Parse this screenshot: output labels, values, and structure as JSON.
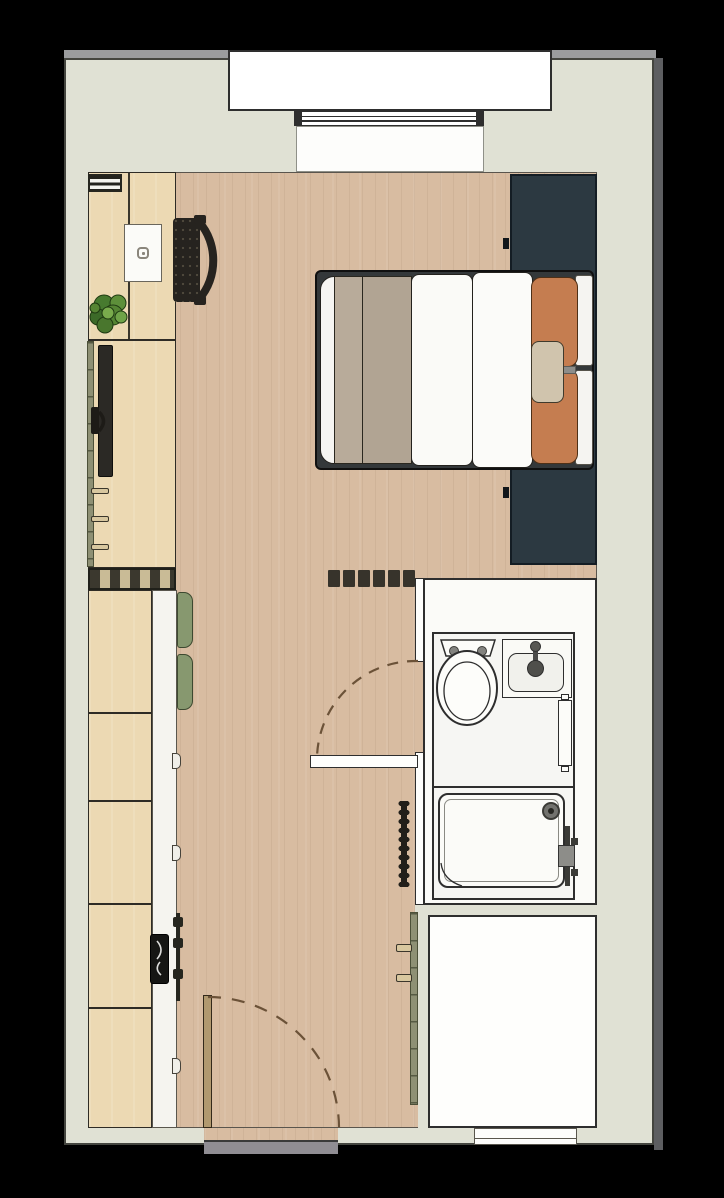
{
  "title": "Studio apartment floor plan",
  "colors": {
    "background": "#000000",
    "wall": "#e0e1d4",
    "wall_edge": "#9b9c9e",
    "outer_edge": "#5d5e61",
    "outline": "#2e2e2e",
    "floor": "#d8bca1",
    "furniture": "#ecd9b3",
    "furniture_line": "#2e2b25",
    "counter": "#f5f4ef",
    "white": "#fdfdfb",
    "tv": "#2b2925",
    "chair_dark": "#26231f",
    "navy": "#2c3941",
    "bed_frame": "#34383a",
    "taupe_a": "#b8ab9a",
    "taupe_b": "#b1a493",
    "duvet": "#fafaf7",
    "orange": "#c57d50",
    "cushion": "#d0c4ad",
    "green": "#87986f",
    "olive": "#8e9074",
    "plant_dark": "#3c6a28",
    "plant_mid": "#4f7f30",
    "plant_light": "#6fa348",
    "door_arc": "#6b5238",
    "door_leaf": "#b1996f",
    "threshold": "#908d93",
    "stripe_dark": "#3b382e",
    "stripe_light": "#c9bb96",
    "handle": "#d8c79f",
    "fixture": "#3b3b37",
    "sink_black": "#161614"
  },
  "items": [
    {
      "name": "balcony-window-bay"
    },
    {
      "name": "window-glazing"
    },
    {
      "name": "window-sill"
    },
    {
      "name": "desk-unit"
    },
    {
      "name": "vent-grille"
    },
    {
      "name": "laptop"
    },
    {
      "name": "office-chair"
    },
    {
      "name": "plant"
    },
    {
      "name": "tv-lowboard"
    },
    {
      "name": "wall-tv"
    },
    {
      "name": "tv-bracket"
    },
    {
      "name": "radiator"
    },
    {
      "name": "kitchen-cabinets"
    },
    {
      "name": "kitchen-worktop"
    },
    {
      "name": "kitchen-sink"
    },
    {
      "name": "stools",
      "count": 2
    },
    {
      "name": "wardrobe-top"
    },
    {
      "name": "wardrobe-bottom"
    },
    {
      "name": "double-bed"
    },
    {
      "name": "duvet"
    },
    {
      "name": "blanket"
    },
    {
      "name": "pillows-orange",
      "count": 2
    },
    {
      "name": "lumbar-cushion"
    },
    {
      "name": "clothes-rail-dashes"
    },
    {
      "name": "bathroom"
    },
    {
      "name": "toilet"
    },
    {
      "name": "vanity-sink"
    },
    {
      "name": "towel-radiator"
    },
    {
      "name": "shower-tray"
    },
    {
      "name": "shower-drain"
    },
    {
      "name": "bathroom-door"
    },
    {
      "name": "bathroom-door-swing"
    },
    {
      "name": "entrance-door"
    },
    {
      "name": "entrance-door-swing"
    },
    {
      "name": "entrance-threshold"
    },
    {
      "name": "secondary-room"
    },
    {
      "name": "partition-strip"
    },
    {
      "name": "peg-rail"
    }
  ]
}
